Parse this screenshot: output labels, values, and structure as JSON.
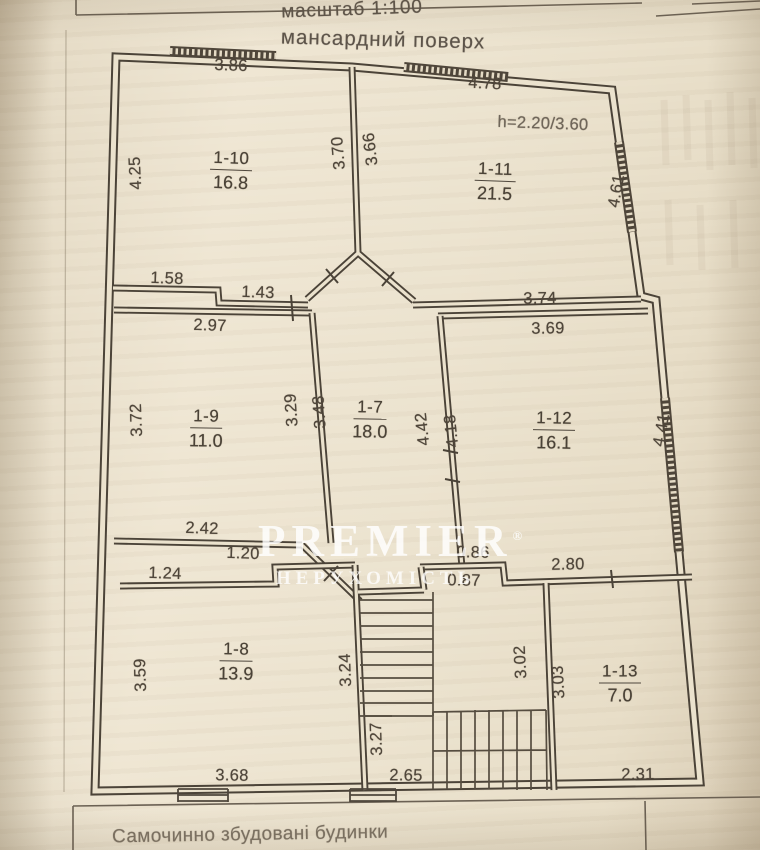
{
  "header": {
    "scale_label": "масштаб 1:100",
    "floor_title": "мансардний поверх"
  },
  "footer": {
    "caption": "Самочинно збудовані будинки"
  },
  "watermark": {
    "brand": "PREMIER",
    "registered": "®",
    "subtitle": "НЕРУХОМІСТЬ"
  },
  "plan": {
    "height_note": "h=2.20/3.60",
    "rooms": [
      {
        "id": "1-10",
        "area": "16.8"
      },
      {
        "id": "1-11",
        "area": "21.5"
      },
      {
        "id": "1-9",
        "area": "11.0"
      },
      {
        "id": "1-7",
        "area": "18.0"
      },
      {
        "id": "1-12",
        "area": "16.1"
      },
      {
        "id": "1-8",
        "area": "13.9"
      },
      {
        "id": "1-13",
        "area": "7.0"
      }
    ],
    "dims": {
      "d386": "3.86",
      "d478": "4.78",
      "d425": "4.25",
      "d370": "3.70",
      "d366": "3.66",
      "d461": "4.61",
      "d158": "1.58",
      "d143": "1.43",
      "d374": "3.74",
      "d297": "2.97",
      "d369": "3.69",
      "d372": "3.72",
      "d329": "3.29",
      "d348": "3.48",
      "d442": "4.42",
      "d418": "4.18",
      "d441": "4.41",
      "d242": "2.42",
      "d120": "1.20",
      "d124": "1.24",
      "d086": "0.86",
      "d087": "0.87",
      "d280": "2.80",
      "d359": "3.59",
      "d324": "3.24",
      "d302": "3.02",
      "d303": "3.03",
      "d327": "3.27",
      "d265": "2.65",
      "d368": "3.68",
      "d231": "2.31"
    }
  }
}
